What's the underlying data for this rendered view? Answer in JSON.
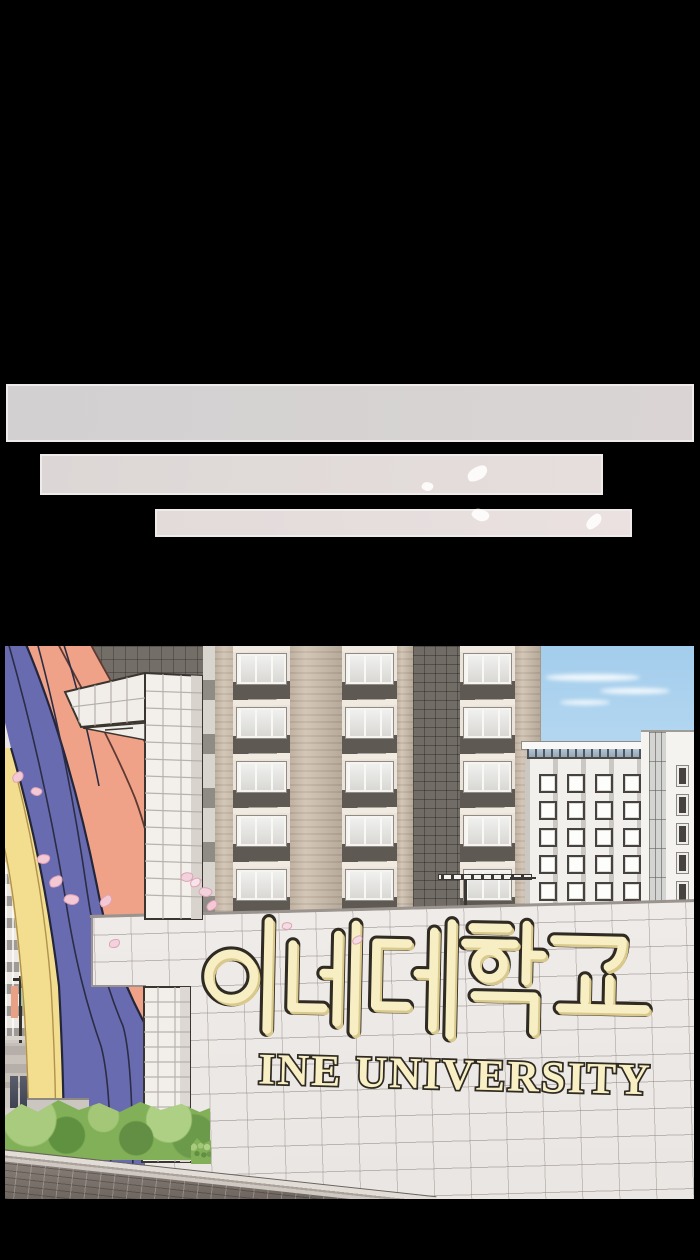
{
  "panel": {
    "alt": "University entrance: rainbow arch gate, white tiled wall and apartment towers, cherry petals drifting"
  },
  "gate_sign": {
    "korean": "이네대학교",
    "english": "INE UNIVERSITY"
  },
  "speech_bars": {
    "count": 3,
    "texts": [
      "",
      "",
      ""
    ]
  },
  "palette": {
    "background": "#000000",
    "bar_grey": "#d5d2d3",
    "bar_pink": "#e6dedd",
    "rainbow_salmon": "#f0a289",
    "rainbow_blue": "#696bb1",
    "rainbow_yellow": "#f3dd8e",
    "sign_cream": "#f7efc3",
    "sign_outline": "#2f2a22",
    "sky": "#aed3ee",
    "hedge_green": "#82b058"
  }
}
